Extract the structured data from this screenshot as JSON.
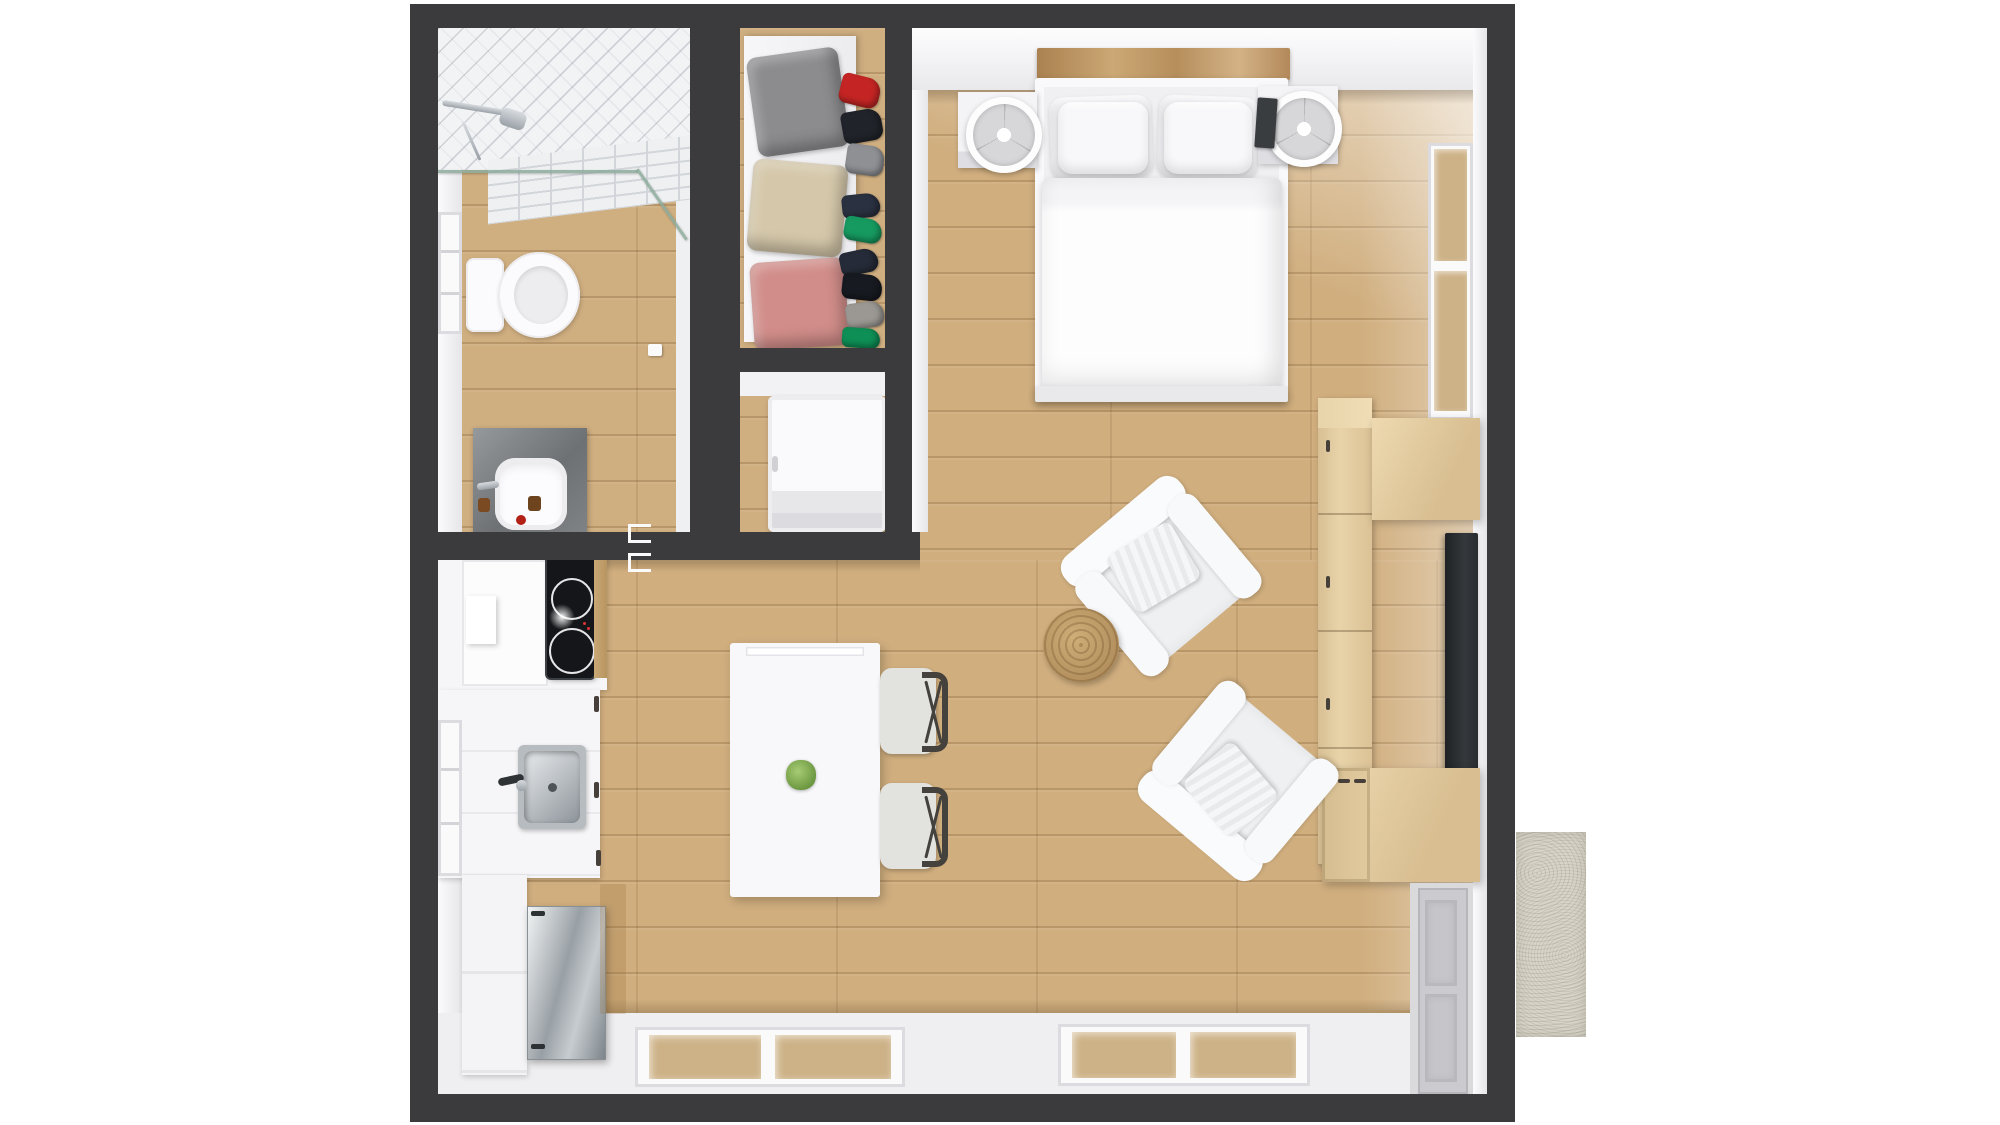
{
  "labels": {
    "scene": "3D top-down floor plan of a studio apartment",
    "bathroom": "Bathroom",
    "shower": "Walk-in shower with subway tile",
    "toilet": "Toilet",
    "vanity": "Concrete vanity with vessel sink",
    "closet": "Wardrobe closet with clothes",
    "laundry": "Laundry nook",
    "washer": "Washing machine",
    "bedroom": "Bedroom area",
    "bed": "Double bed with white bedding",
    "nightstand": "Nightstand with round lamp",
    "headboard": "Wood headboard shelf",
    "kitchen": "Kitchenette",
    "cooktop": "Two-burner cooktop",
    "kitchen_sink": "Stainless kitchen sink",
    "oven": "Stainless oven-dishwasher",
    "dining": "White dining table",
    "dining_chair": "Dining chair",
    "living": "Living area",
    "armchair": "White armchair",
    "pouf": "Round jute pouf",
    "media": "Media wall cabinetry",
    "tv": "Wall-mounted TV",
    "entry": "Entrance door",
    "doormat": "Doormat",
    "window": "Window"
  },
  "palette": {
    "wall": "#3b3b3d",
    "wall-face": "#ededf0",
    "floor": "#cfae80",
    "tile": "#f2f3f5",
    "concrete": "#7e8184",
    "steel": "#a9afb4",
    "wood": "#e3cda1",
    "wood-dark": "#b68a58",
    "tv": "#282b2e",
    "jute": "#c2a271",
    "chair-frame": "#45413c",
    "mat": "#d7d4c8",
    "plant": "#7fae52",
    "glass-tint": "#cdb287"
  },
  "closet_items": {
    "folded": [
      {
        "name": "folded-gray-sweater",
        "color": "#8c8c8e"
      },
      {
        "name": "folded-beige-sweater",
        "color": "#d5c8aa"
      },
      {
        "name": "folded-rose-sweater",
        "color": "#d18d89"
      }
    ],
    "pile": [
      {
        "name": "red-item",
        "color": "#c42524"
      },
      {
        "name": "black-item",
        "color": "#20242a"
      },
      {
        "name": "gray-item",
        "color": "#8f9094"
      },
      {
        "name": "navy-item",
        "color": "#2a3140"
      },
      {
        "name": "green-item",
        "color": "#169a60"
      },
      {
        "name": "navy-item-2",
        "color": "#252b38"
      },
      {
        "name": "black-item-2",
        "color": "#171a20"
      },
      {
        "name": "gray-item-2",
        "color": "#9b9893"
      },
      {
        "name": "green-item-2",
        "color": "#0e8f56"
      }
    ]
  }
}
